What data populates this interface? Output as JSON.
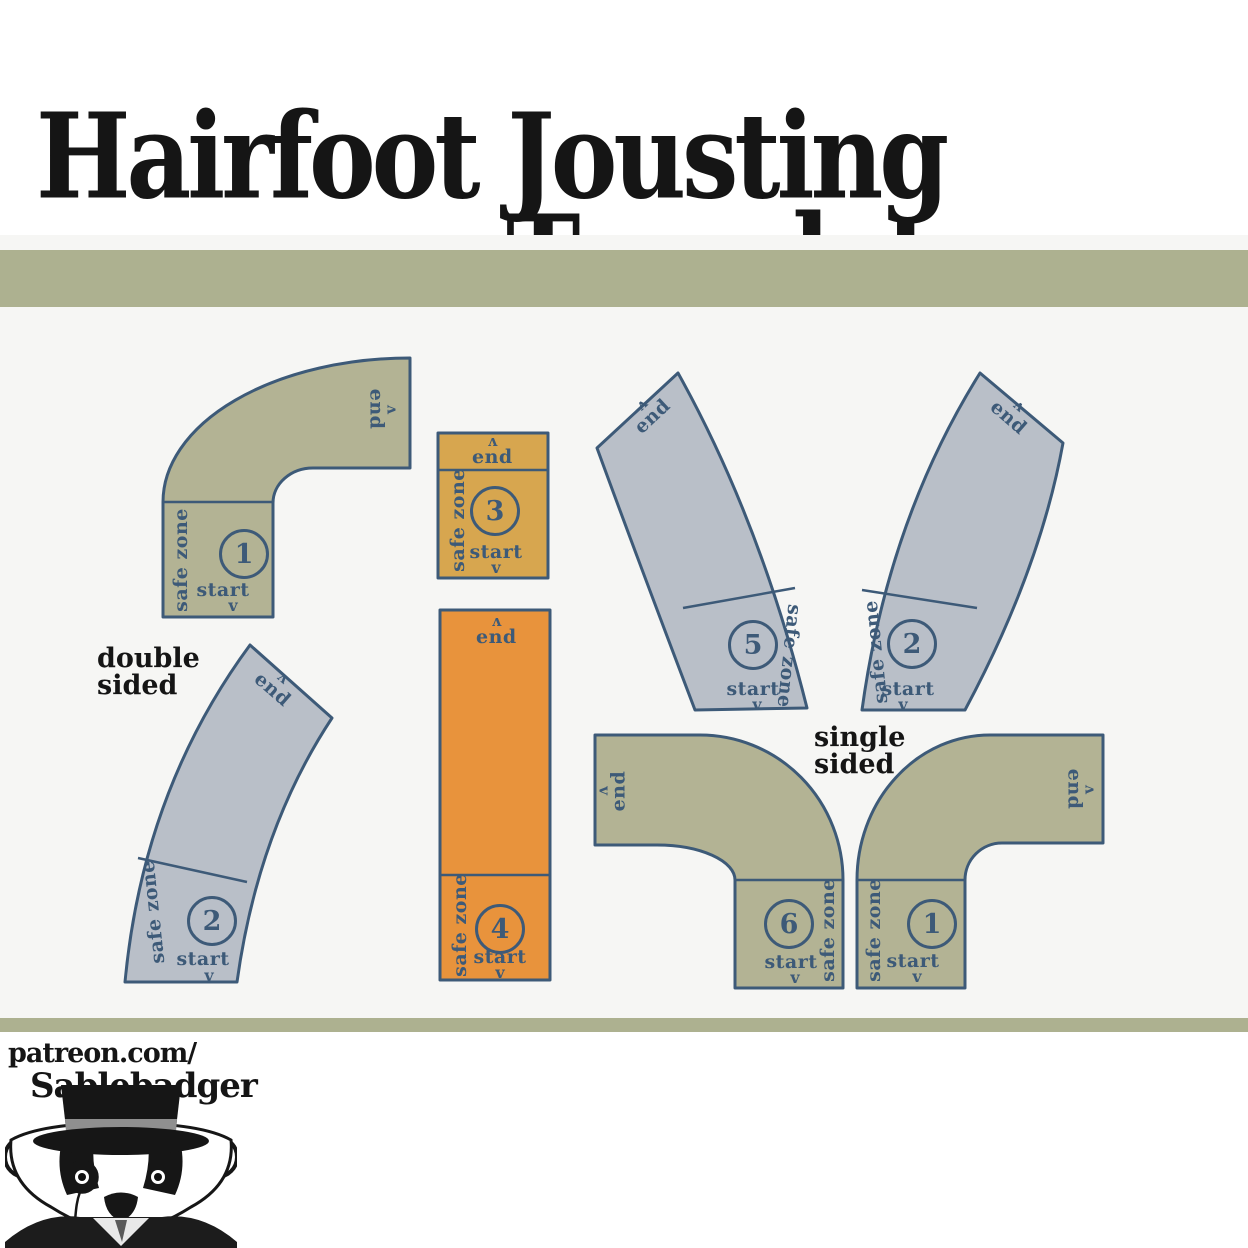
{
  "title": {
    "line1": "Hairfoot Jousting",
    "line2": "Templates"
  },
  "section_labels": {
    "double_sided": {
      "line1": "double",
      "line2": "sided"
    },
    "single_sided": {
      "line1": "single",
      "line2": "sided"
    }
  },
  "templates": [
    {
      "id": "olive-elbow-top-left",
      "number": "1",
      "safe_zone_label": "safe zone",
      "start_label": "start",
      "end_label": "end",
      "color_name": "olive"
    },
    {
      "id": "gold-straight-short",
      "number": "3",
      "safe_zone_label": "safe zone",
      "start_label": "start",
      "end_label": "end",
      "color_name": "gold"
    },
    {
      "id": "gray-curve-middle",
      "number": "5",
      "safe_zone_label": "safe zone",
      "start_label": "start",
      "end_label": "end",
      "color_name": "gray_blue"
    },
    {
      "id": "gray-curve-right",
      "number": "2",
      "safe_zone_label": "safe zone",
      "start_label": "start",
      "end_label": "end",
      "color_name": "gray_blue"
    },
    {
      "id": "gray-curve-left",
      "number": "2",
      "safe_zone_label": "safe zone",
      "start_label": "start",
      "end_label": "end",
      "color_name": "gray_blue"
    },
    {
      "id": "orange-straight-long",
      "number": "4",
      "safe_zone_label": "safe zone",
      "start_label": "start",
      "end_label": "end",
      "color_name": "orange"
    },
    {
      "id": "olive-elbow-bottom-mid",
      "number": "6",
      "safe_zone_label": "safe zone",
      "start_label": "start",
      "end_label": "end",
      "color_name": "olive"
    },
    {
      "id": "olive-elbow-bottom-right",
      "number": "1",
      "safe_zone_label": "safe zone",
      "start_label": "start",
      "end_label": "end",
      "color_name": "olive"
    }
  ],
  "icons": {
    "arrow": "v",
    "mascot": "badger-with-top-hat-and-monocle"
  },
  "footer": {
    "patreon_line1": "patreon.com/",
    "patreon_line2": "Sablebadger"
  },
  "colors": {
    "olive": "#b3b394",
    "gray_blue": "#b9bfc8",
    "gold": "#d7a64f",
    "orange": "#e8933c",
    "outline": "#3d5a78",
    "band": "#adb190",
    "page_bg": "#f6f6f4",
    "white": "#ffffff",
    "black": "#151515"
  }
}
